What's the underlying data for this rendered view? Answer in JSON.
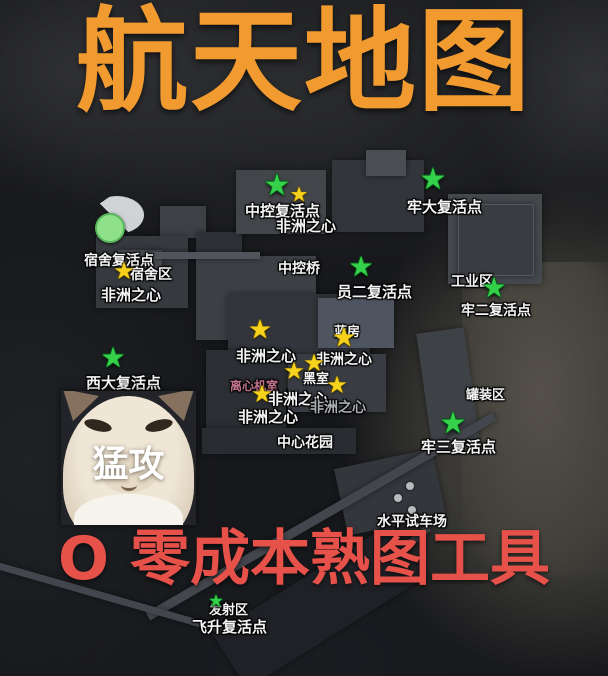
{
  "title": {
    "text": "航天地图",
    "color": "#F09A30"
  },
  "subtitle": {
    "text": "O 零成本熟图工具",
    "color": "#E65149"
  },
  "meme": {
    "caption": "猛攻"
  },
  "colors": {
    "respawn_marker_green": "#35D14A",
    "respawn_circle_green": "#8EE08A",
    "loot_marker_yellow": "#F6D21C",
    "label_white": "#F4F4F4",
    "label_gray": "#A9ADB2",
    "label_purple": "#C2748E"
  },
  "map": {
    "labels": [
      {
        "text": "中控复活点",
        "x": 245,
        "y": 200,
        "size": 15,
        "style": "white",
        "name": "central-control-respawn-label"
      },
      {
        "text": "非洲之心",
        "x": 276,
        "y": 215,
        "size": 15,
        "style": "white",
        "name": "africa-heart-label"
      },
      {
        "text": "牢大复活点",
        "x": 407,
        "y": 196,
        "size": 15,
        "style": "white",
        "name": "laoda-respawn-label"
      },
      {
        "text": "宿舍复活点",
        "x": 84,
        "y": 250,
        "size": 14,
        "style": "white",
        "name": "dorm-respawn-label"
      },
      {
        "text": "宿舍区",
        "x": 130,
        "y": 264,
        "size": 14,
        "style": "white",
        "name": "dorm-area-label"
      },
      {
        "text": "非洲之心",
        "x": 101,
        "y": 284,
        "size": 15,
        "style": "white",
        "name": "africa-heart-label"
      },
      {
        "text": "中控桥",
        "x": 278,
        "y": 258,
        "size": 14,
        "style": "white",
        "name": "central-bridge-label"
      },
      {
        "text": "员二复活点",
        "x": 337,
        "y": 281,
        "size": 15,
        "style": "white",
        "name": "yuan2-respawn-label"
      },
      {
        "text": "工业区",
        "x": 451,
        "y": 271,
        "size": 14,
        "style": "white",
        "name": "industrial-area-label"
      },
      {
        "text": "牢二复活点",
        "x": 461,
        "y": 300,
        "size": 14,
        "style": "white",
        "name": "lao2-respawn-label"
      },
      {
        "text": "非洲之心",
        "x": 236,
        "y": 345,
        "size": 15,
        "style": "white",
        "name": "africa-heart-label"
      },
      {
        "text": "蓝房",
        "x": 334,
        "y": 321,
        "size": 13,
        "style": "white",
        "name": "blue-house-label"
      },
      {
        "text": "非洲之心",
        "x": 316,
        "y": 349,
        "size": 14,
        "style": "white",
        "name": "africa-heart-label"
      },
      {
        "text": "黑室",
        "x": 303,
        "y": 368,
        "size": 13,
        "style": "white",
        "name": "black-room-label"
      },
      {
        "text": "离心机室",
        "x": 230,
        "y": 377,
        "size": 12,
        "style": "purple",
        "name": "centrifuge-room-label"
      },
      {
        "text": "非洲之心",
        "x": 268,
        "y": 388,
        "size": 15,
        "style": "white",
        "name": "africa-heart-label"
      },
      {
        "text": "非洲之心",
        "x": 310,
        "y": 397,
        "size": 14,
        "style": "gray",
        "name": "africa-heart-label"
      },
      {
        "text": "非洲之心",
        "x": 238,
        "y": 406,
        "size": 15,
        "style": "white",
        "name": "africa-heart-label"
      },
      {
        "text": "西大复活点",
        "x": 86,
        "y": 372,
        "size": 15,
        "style": "white",
        "name": "west-respawn-label"
      },
      {
        "text": "中心花园",
        "x": 277,
        "y": 432,
        "size": 14,
        "style": "white",
        "name": "central-garden-label"
      },
      {
        "text": "罐装区",
        "x": 466,
        "y": 384,
        "size": 13,
        "style": "white",
        "name": "canning-area-label"
      },
      {
        "text": "牢三复活点",
        "x": 421,
        "y": 436,
        "size": 15,
        "style": "white",
        "name": "lao3-respawn-label"
      },
      {
        "text": "水平试车场",
        "x": 377,
        "y": 511,
        "size": 14,
        "style": "white",
        "name": "horizontal-test-site-label"
      },
      {
        "text": "发射区",
        "x": 209,
        "y": 599,
        "size": 13,
        "style": "white",
        "name": "launch-area-label"
      },
      {
        "text": "飞升复活点",
        "x": 192,
        "y": 616,
        "size": 15,
        "style": "white",
        "name": "feisheng-respawn-label"
      }
    ],
    "markers": [
      {
        "type": "green-circle",
        "x": 110,
        "y": 228,
        "size": 26,
        "name": "dorm-respawn-circle-marker"
      },
      {
        "type": "green-star",
        "x": 277,
        "y": 186,
        "size": 30,
        "name": "central-control-respawn-star-marker"
      },
      {
        "type": "green-star",
        "x": 433,
        "y": 180,
        "size": 30,
        "name": "laoda-respawn-star-marker"
      },
      {
        "type": "green-star",
        "x": 361,
        "y": 267,
        "size": 28,
        "name": "yuan2-respawn-star-marker"
      },
      {
        "type": "green-star",
        "x": 494,
        "y": 288,
        "size": 28,
        "name": "lao2-respawn-star-marker"
      },
      {
        "type": "green-star",
        "x": 113,
        "y": 358,
        "size": 28,
        "name": "west-respawn-star-marker"
      },
      {
        "type": "green-star",
        "x": 453,
        "y": 424,
        "size": 30,
        "name": "lao3-respawn-star-marker"
      },
      {
        "type": "green-star",
        "x": 216,
        "y": 602,
        "size": 17,
        "name": "launch-respawn-star-marker"
      },
      {
        "type": "yellow-star",
        "x": 299,
        "y": 195,
        "size": 21,
        "name": "loot-star-marker"
      },
      {
        "type": "yellow-star",
        "x": 124,
        "y": 271,
        "size": 24,
        "name": "loot-star-marker"
      },
      {
        "type": "yellow-star",
        "x": 260,
        "y": 330,
        "size": 27,
        "name": "loot-star-marker"
      },
      {
        "type": "yellow-star",
        "x": 344,
        "y": 338,
        "size": 27,
        "name": "loot-star-marker"
      },
      {
        "type": "yellow-star",
        "x": 314,
        "y": 363,
        "size": 24,
        "name": "loot-star-marker"
      },
      {
        "type": "yellow-star",
        "x": 294,
        "y": 371,
        "size": 24,
        "name": "loot-star-marker"
      },
      {
        "type": "yellow-star",
        "x": 337,
        "y": 385,
        "size": 24,
        "name": "loot-star-marker"
      },
      {
        "type": "yellow-star",
        "x": 262,
        "y": 394,
        "size": 24,
        "name": "loot-star-marker"
      }
    ]
  }
}
